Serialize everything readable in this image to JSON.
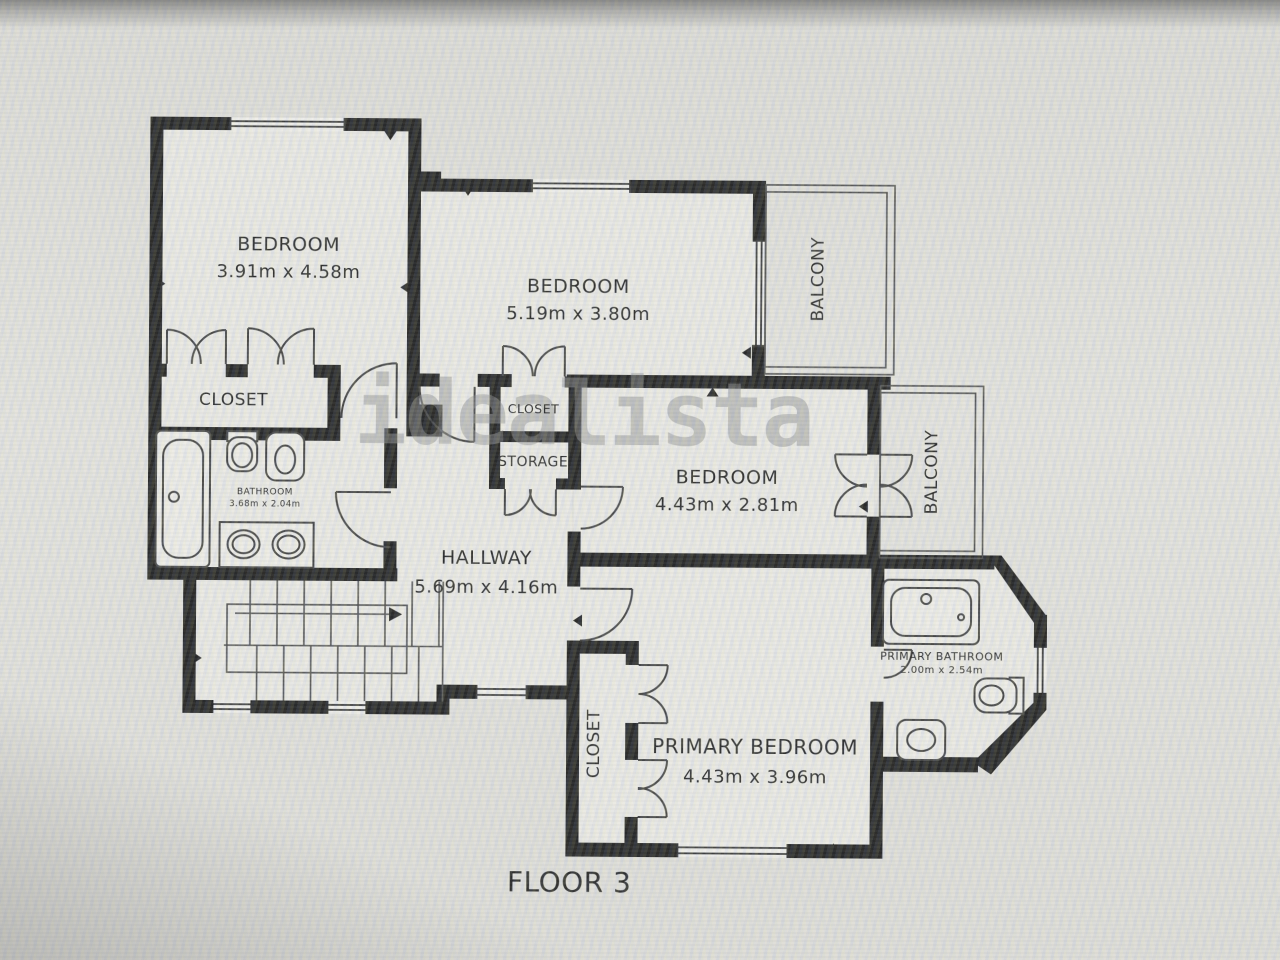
{
  "floor_label": "FLOOR 3",
  "watermark": "idealista",
  "colors": {
    "wall": "#171717",
    "room_fill": "#ecebe7",
    "background": "#dcdbd7",
    "thin_line": "#3a3a3a",
    "watermark": "#8c8c8c",
    "text": "#1d1d1d"
  },
  "rooms": {
    "bedroom1": {
      "name": "BEDROOM",
      "dims": "3.91m x 4.58m"
    },
    "bedroom2": {
      "name": "BEDROOM",
      "dims": "5.19m x 3.80m"
    },
    "bedroom3": {
      "name": "BEDROOM",
      "dims": "4.43m x 2.81m"
    },
    "primary_bedroom": {
      "name": "PRIMARY BEDROOM",
      "dims": "4.43m x 3.96m"
    },
    "hallway": {
      "name": "HALLWAY",
      "dims": "5.69m x 4.16m"
    },
    "bathroom": {
      "name": "BATHROOM",
      "dims": "3.68m x 2.04m"
    },
    "primary_bathroom": {
      "name": "PRIMARY BATHROOM",
      "dims": "2.00m x 2.54m"
    },
    "closet1": {
      "name": "CLOSET"
    },
    "closet2": {
      "name": "CLOSET"
    },
    "closet3": {
      "name": "CLOSET"
    },
    "storage": {
      "name": "STORAGE"
    },
    "balcony1": {
      "name": "BALCONY"
    },
    "balcony2": {
      "name": "BALCONY"
    }
  }
}
